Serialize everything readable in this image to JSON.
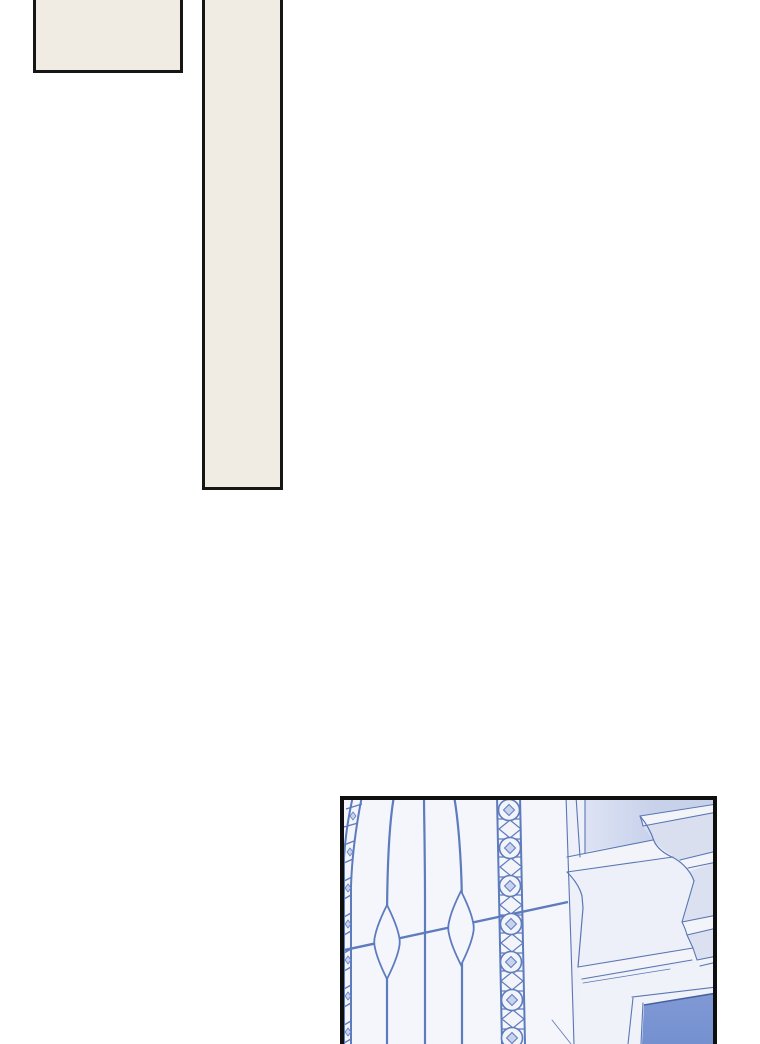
{
  "page": {
    "width": 760,
    "height": 1044,
    "background": "#ffffff"
  },
  "colors": {
    "panel_border": "#0f0f0f",
    "cream": "#f0ece3",
    "glass": "#f4f6fc",
    "lead": "#5d7bbd",
    "lead_light": "#c7d2ee",
    "band_white": "#f2f4fa",
    "wall_shade_left": "#dde3f4",
    "wall_shade": "#c7d1ea",
    "face_light": "#edf0f8",
    "face_mid": "#dbe1f1",
    "below_sill": "#eff2f9",
    "blue_pane": "#7b96d2",
    "blue_pane_light": "#8099d5",
    "blue_pane_dark": "#7490cf",
    "blue_pane_edge": "#45619f",
    "arch_line": "#5a76b4"
  },
  "panels": [
    {
      "id": "small-rectangle",
      "description": "empty cream panel fragment, clipped by top edge"
    },
    {
      "id": "tall-bar",
      "description": "tall narrow cream panel fragment, clipped by top edge"
    },
    {
      "id": "window-illustration",
      "description": "arched stained-glass window with leaded tracery, marquise ornaments, circle-and-diamond border band, white stone molding and blue glass pane"
    }
  ]
}
